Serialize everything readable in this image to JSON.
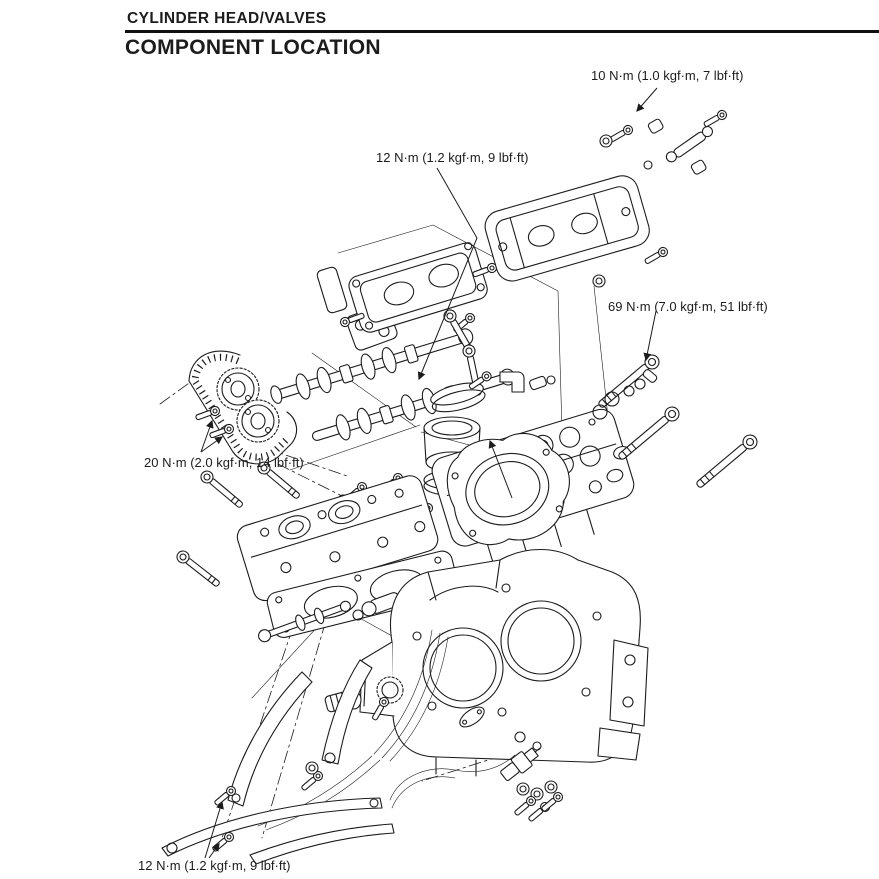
{
  "page": {
    "section": "CYLINDER HEAD/VALVES",
    "title": "COMPONENT LOCATION"
  },
  "torque_labels": [
    {
      "id": "torque-valve-cover-bolts",
      "text": "10 N·m (1.0 kgf·m, 7 lbf·ft)"
    },
    {
      "id": "torque-breather-plate-bolts",
      "text": "12 N·m (1.2 kgf·m, 9 lbf·ft)"
    },
    {
      "id": "torque-cylinder-head-bolts",
      "text": "69 N·m (7.0 kgf·m, 51 lbf·ft)"
    },
    {
      "id": "torque-cam-sprocket-bolts",
      "text": "20 N·m (2.0 kgf·m, 14 lbf·ft)"
    },
    {
      "id": "torque-chain-guide-bolts",
      "text": "12 N·m (1.2 kgf·m, 9 lbf·ft)"
    }
  ],
  "diagram": {
    "parts": [
      "cylinder-head-cover",
      "breather-plate",
      "camshafts",
      "cam-sprockets",
      "cam-chain",
      "intake-funnel",
      "rear-cylinder-head",
      "stud-bolts",
      "front-cylinder-head",
      "head-gasket",
      "cylinder-block",
      "cam-chain-guides",
      "tensioner-lifter",
      "spark-plug"
    ]
  },
  "colors": {
    "ink": "#1c1c1c",
    "paper": "#ffffff"
  }
}
